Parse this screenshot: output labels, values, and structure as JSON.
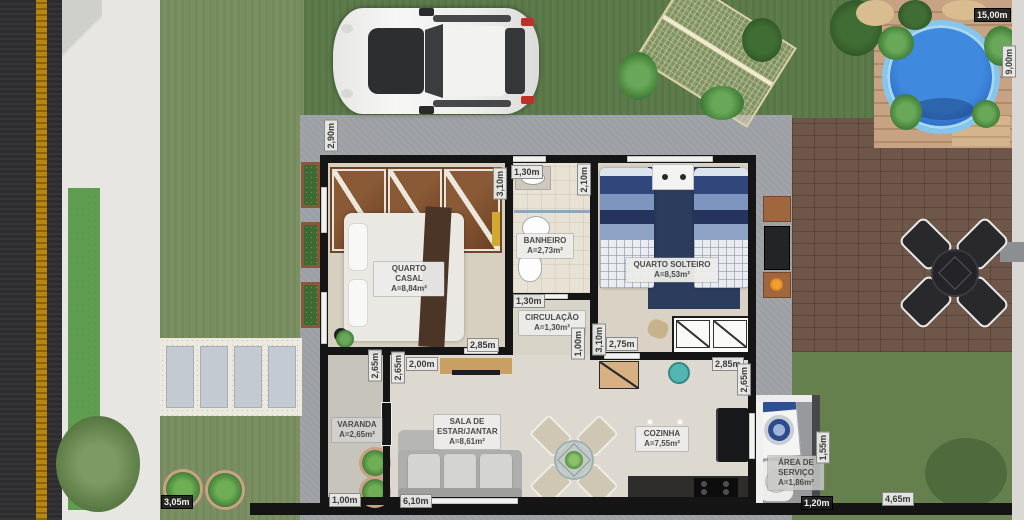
{
  "title": "House floor plan 3D render",
  "rooms": {
    "quarto_casal": {
      "name": "QUARTO CASAL",
      "area": "A=8,84m²"
    },
    "banheiro": {
      "name": "BANHEIRO",
      "area": "A=2,73m²"
    },
    "quarto_solteiro": {
      "name": "QUARTO SOLTEIRO",
      "area": "A=8,53m²"
    },
    "circulacao": {
      "name": "CIRCULAÇÃO",
      "area": "A=1,30m²"
    },
    "varanda": {
      "name": "VARANDA",
      "area": "A=2,65m²"
    },
    "sala": {
      "name": "SALA DE ESTAR/JANTAR",
      "area": "A=8,61m²"
    },
    "cozinha": {
      "name": "COZINHA",
      "area": "A=7,55m²"
    },
    "area_servico": {
      "name": "ÁREA DE SERVIÇO",
      "area": "A=1,86m²"
    }
  },
  "dims": {
    "d_290": "2,90m",
    "d_130_bath": "1,30m",
    "d_210": "2,10m",
    "d_310_casal": "3,10m",
    "d_285_casal": "2,85m",
    "d_130_circ": "1,30m",
    "d_100_circ": "1,00m",
    "d_310_solt": "3,10m",
    "d_275": "2,75m",
    "d_285_coz": "2,85m",
    "d_265_coz": "2,65m",
    "d_265_var_a": "2,65m",
    "d_265_var_b": "2,65m",
    "d_200": "2,00m",
    "d_100_var": "1,00m",
    "d_610": "6,10m",
    "d_155": "1,55m",
    "d_120": "1,20m",
    "d_1500": "15,00m",
    "d_900": "9,00m",
    "d_305": "3,05m",
    "d_465": "4,65m"
  },
  "colors": {
    "grass": "#6d8456",
    "patio_concrete": "#9c9fa3",
    "brick_paving": "#6e5749",
    "pool_water": "#2f6fc6",
    "deck_wood": "#c7a283",
    "wall": "#151515",
    "road_asphalt": "#2d2d2f",
    "road_line": "#b8860f",
    "bed_blue": "#31477c"
  }
}
